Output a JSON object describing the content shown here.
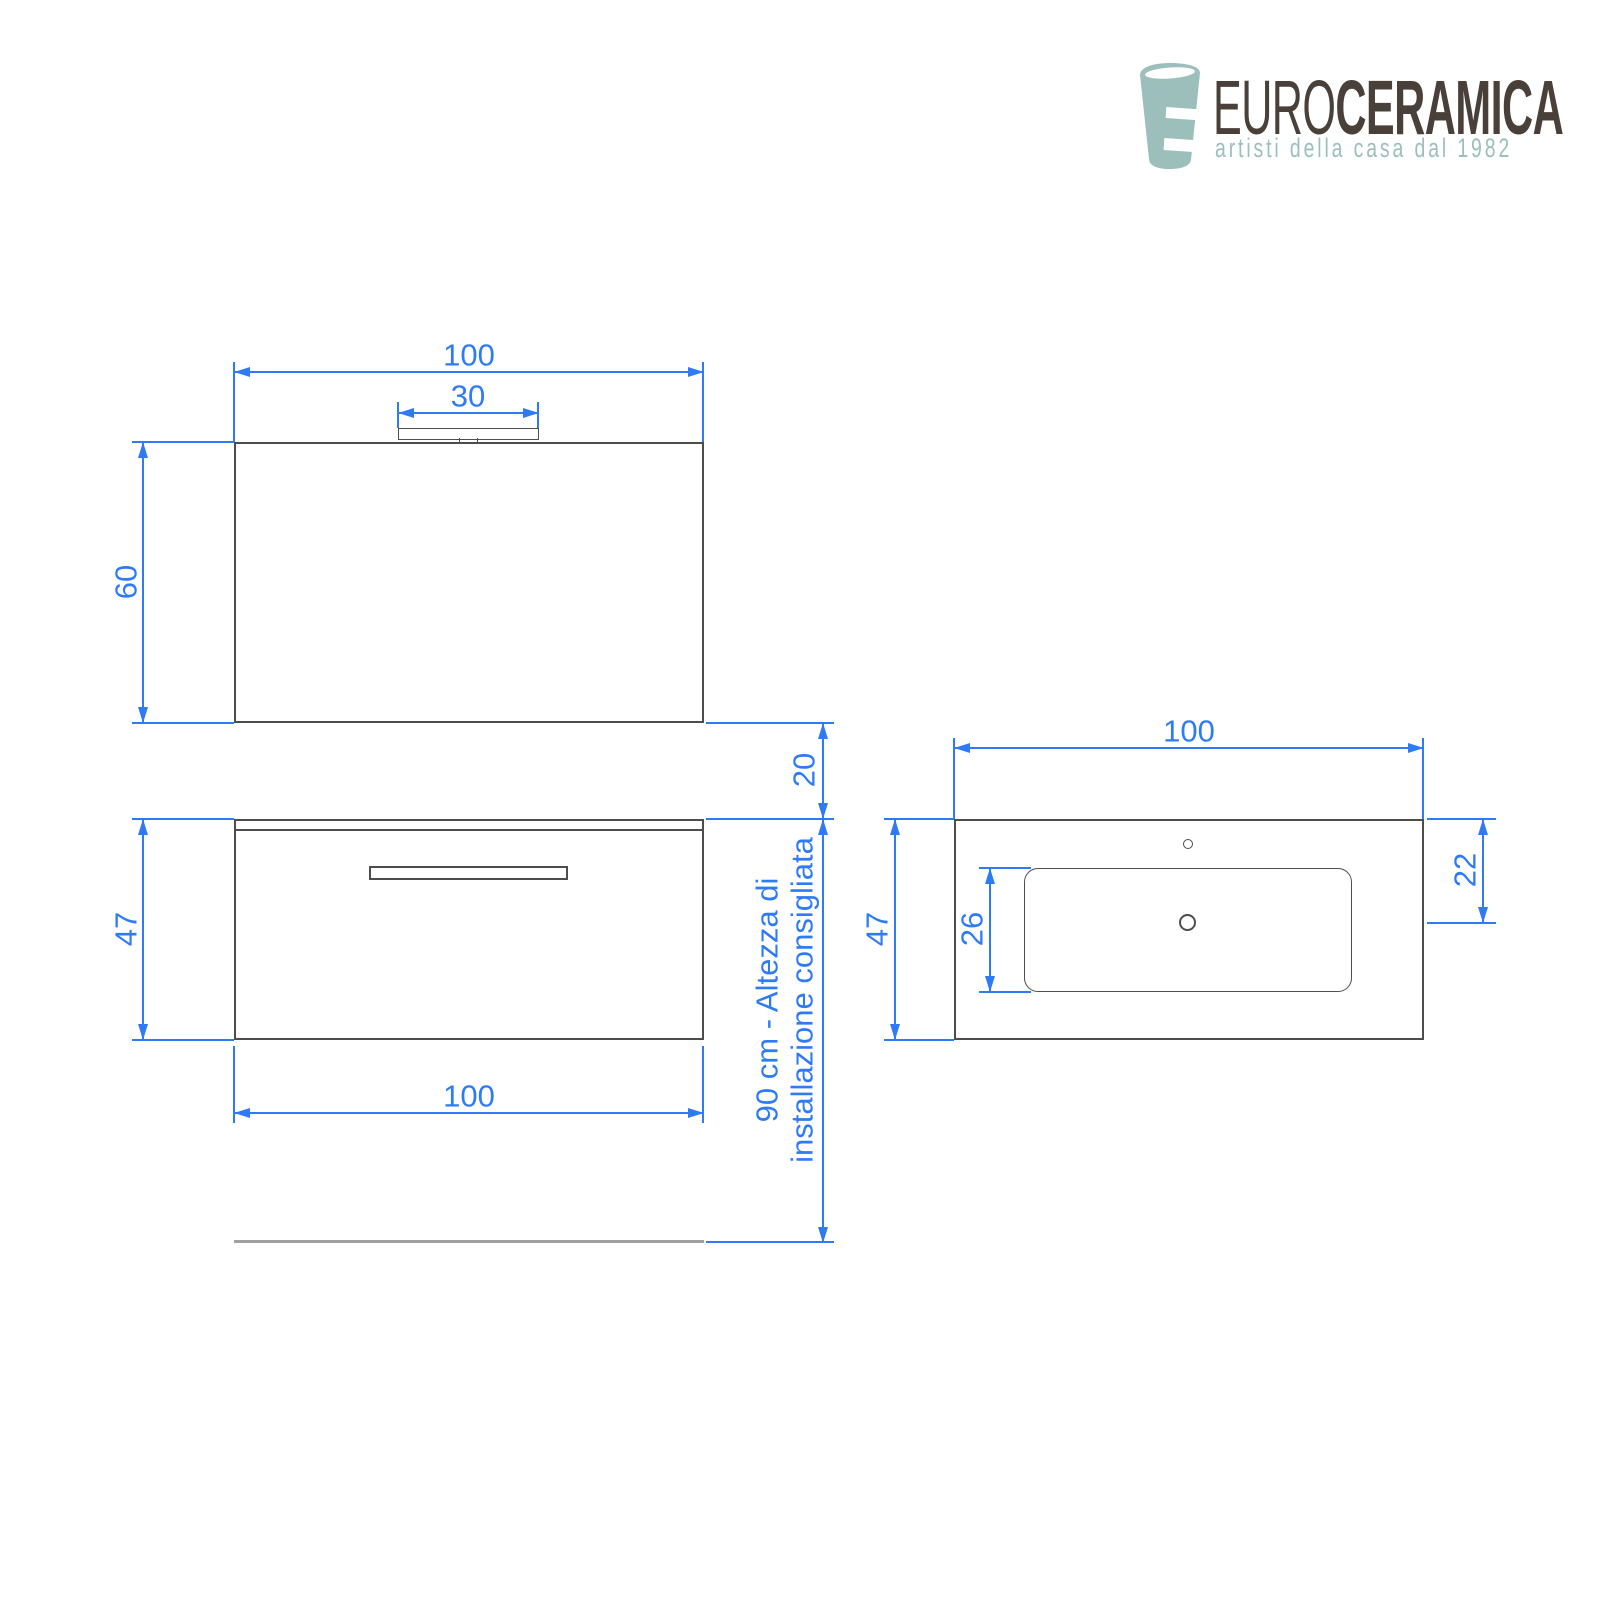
{
  "page": {
    "background": "#ffffff"
  },
  "logo": {
    "brand_prefix": "EURO",
    "brand_suffix": "CERAMICA",
    "tagline": "artisti della casa dal 1982",
    "colors": {
      "teal": "#9cbfbb",
      "brown": "#4a403a"
    }
  },
  "drawing": {
    "colors": {
      "dimension_blue": "#2e7bf5",
      "outline_gray": "#4d4d4d",
      "floor_gray": "#a0a0a0"
    },
    "views": {
      "mirror_front": {
        "dims": {
          "width": "100",
          "lamp_width": "30",
          "height": "60"
        }
      },
      "cabinet_front": {
        "dims": {
          "width": "100",
          "height": "47",
          "wall_gap": "20"
        },
        "install_note_line1": "90 cm - Altezza di",
        "install_note_line2": "installazione consigliata"
      },
      "countertop_plan": {
        "dims": {
          "width": "100",
          "depth": "47",
          "basin_depth": "26",
          "drain_offset": "22"
        }
      }
    }
  }
}
